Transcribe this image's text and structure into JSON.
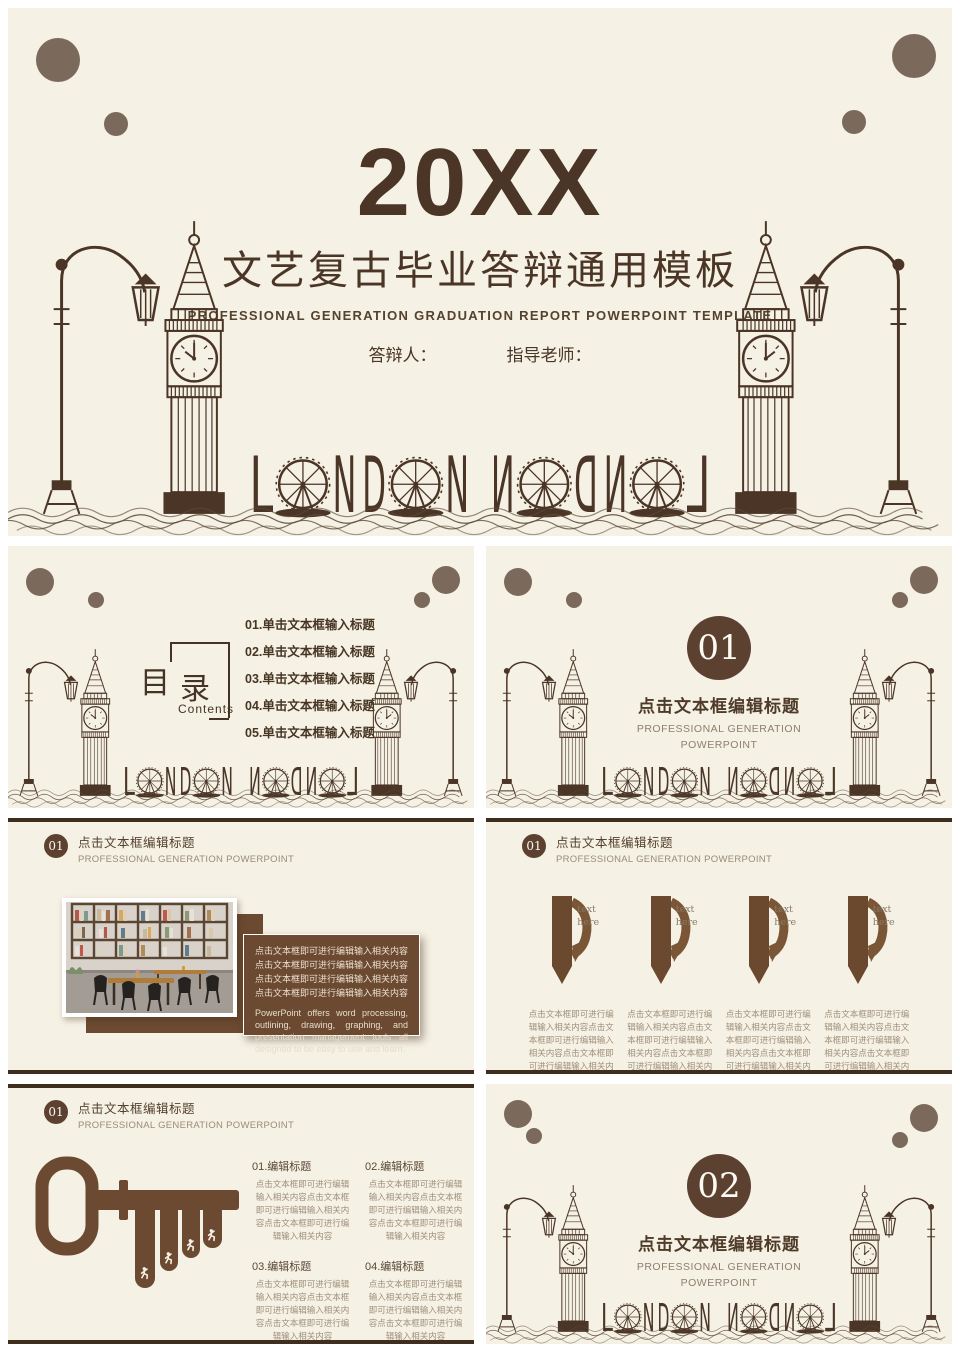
{
  "colors": {
    "slide_bg": "#f5f1e4",
    "dark_brown": "#4a3526",
    "accent_brown": "#6b4a31",
    "badge_brown": "#5d4130",
    "dot_brown": "#7b6a5c",
    "bar_brown": "#3f2e1d"
  },
  "cover": {
    "year": "20XX",
    "title": "文艺复古毕业答辩通用模板",
    "subtitle": "PROFESSIONAL GENERATION GRADUATION REPORT POWERPOINT TEMPLATE",
    "presenter_label": "答辩人：",
    "advisor_label": "指导老师：",
    "city_letters": {
      "l": "L",
      "n1": "N",
      "d": "D",
      "n2": "N"
    }
  },
  "contents": {
    "title_char1": "目",
    "title_char2": "录",
    "subtitle": "Contents",
    "items": [
      "01.单击文本框输入标题",
      "02.单击文本框输入标题",
      "03.单击文本框输入标题",
      "04.单击文本框输入标题",
      "05.单击文本框输入标题"
    ]
  },
  "sections": [
    {
      "number": "01",
      "title": "点击文本框编辑标题",
      "subtitle1": "PROFESSIONAL GENERATION",
      "subtitle2": "POWERPOINT"
    },
    {
      "number": "02",
      "title": "点击文本框编辑标题",
      "subtitle1": "PROFESSIONAL GENERATION",
      "subtitle2": "POWERPOINT"
    }
  ],
  "photo_slide": {
    "badge": "01",
    "title": "点击文本框编辑标题",
    "subtitle": "PROFESSIONAL GENERATION POWERPOINT",
    "body_cn": "点击文本框即可进行编辑输入相关内容点击文本框即可进行编辑输入相关内容点击文本框即可进行编辑输入相关内容点击文本框即可进行编辑输入相关内容",
    "body_en": "PowerPoint offers word processing, outlining, drawing, graphing, and presentation management tools all designed to be easy to use and learn."
  },
  "ribbon_slide": {
    "badge": "01",
    "title": "点击文本框编辑标题",
    "subtitle": "PROFESSIONAL GENERATION POWERPOINT",
    "items": [
      {
        "label_line1": "text",
        "label_line2": "here",
        "body": "点击文本框即可进行编辑输入相关内容点击文本框即可进行编辑输入相关内容点击文本框即可进行编辑输入相关内容"
      },
      {
        "label_line1": "text",
        "label_line2": "here",
        "body": "点击文本框即可进行编辑输入相关内容点击文本框即可进行编辑输入相关内容点击文本框即可进行编辑输入相关内容"
      },
      {
        "label_line1": "text",
        "label_line2": "here",
        "body": "点击文本框即可进行编辑输入相关内容点击文本框即可进行编辑输入相关内容点击文本框即可进行编辑输入相关内容"
      },
      {
        "label_line1": "text",
        "label_line2": "here",
        "body": "点击文本框即可进行编辑输入相关内容点击文本框即可进行编辑输入相关内容点击文本框即可进行编辑输入相关内容"
      }
    ]
  },
  "key_slide": {
    "badge": "01",
    "title": "点击文本框编辑标题",
    "subtitle": "PROFESSIONAL GENERATION POWERPOINT",
    "blocks": [
      {
        "heading": "01.编辑标题",
        "body": "点击文本框即可进行编辑输入相关内容点击文本框即可进行编辑输入相关内容点击文本框即可进行编辑输入相关内容"
      },
      {
        "heading": "02.编辑标题",
        "body": "点击文本框即可进行编辑输入相关内容点击文本框即可进行编辑输入相关内容点击文本框即可进行编辑输入相关内容"
      },
      {
        "heading": "03.编辑标题",
        "body": "点击文本框即可进行编辑输入相关内容点击文本框即可进行编辑输入相关内容点击文本框即可进行编辑输入相关内容"
      },
      {
        "heading": "04.编辑标题",
        "body": "点击文本框即可进行编辑输入相关内容点击文本框即可进行编辑输入相关内容点击文本框即可进行编辑输入相关内容"
      }
    ]
  }
}
